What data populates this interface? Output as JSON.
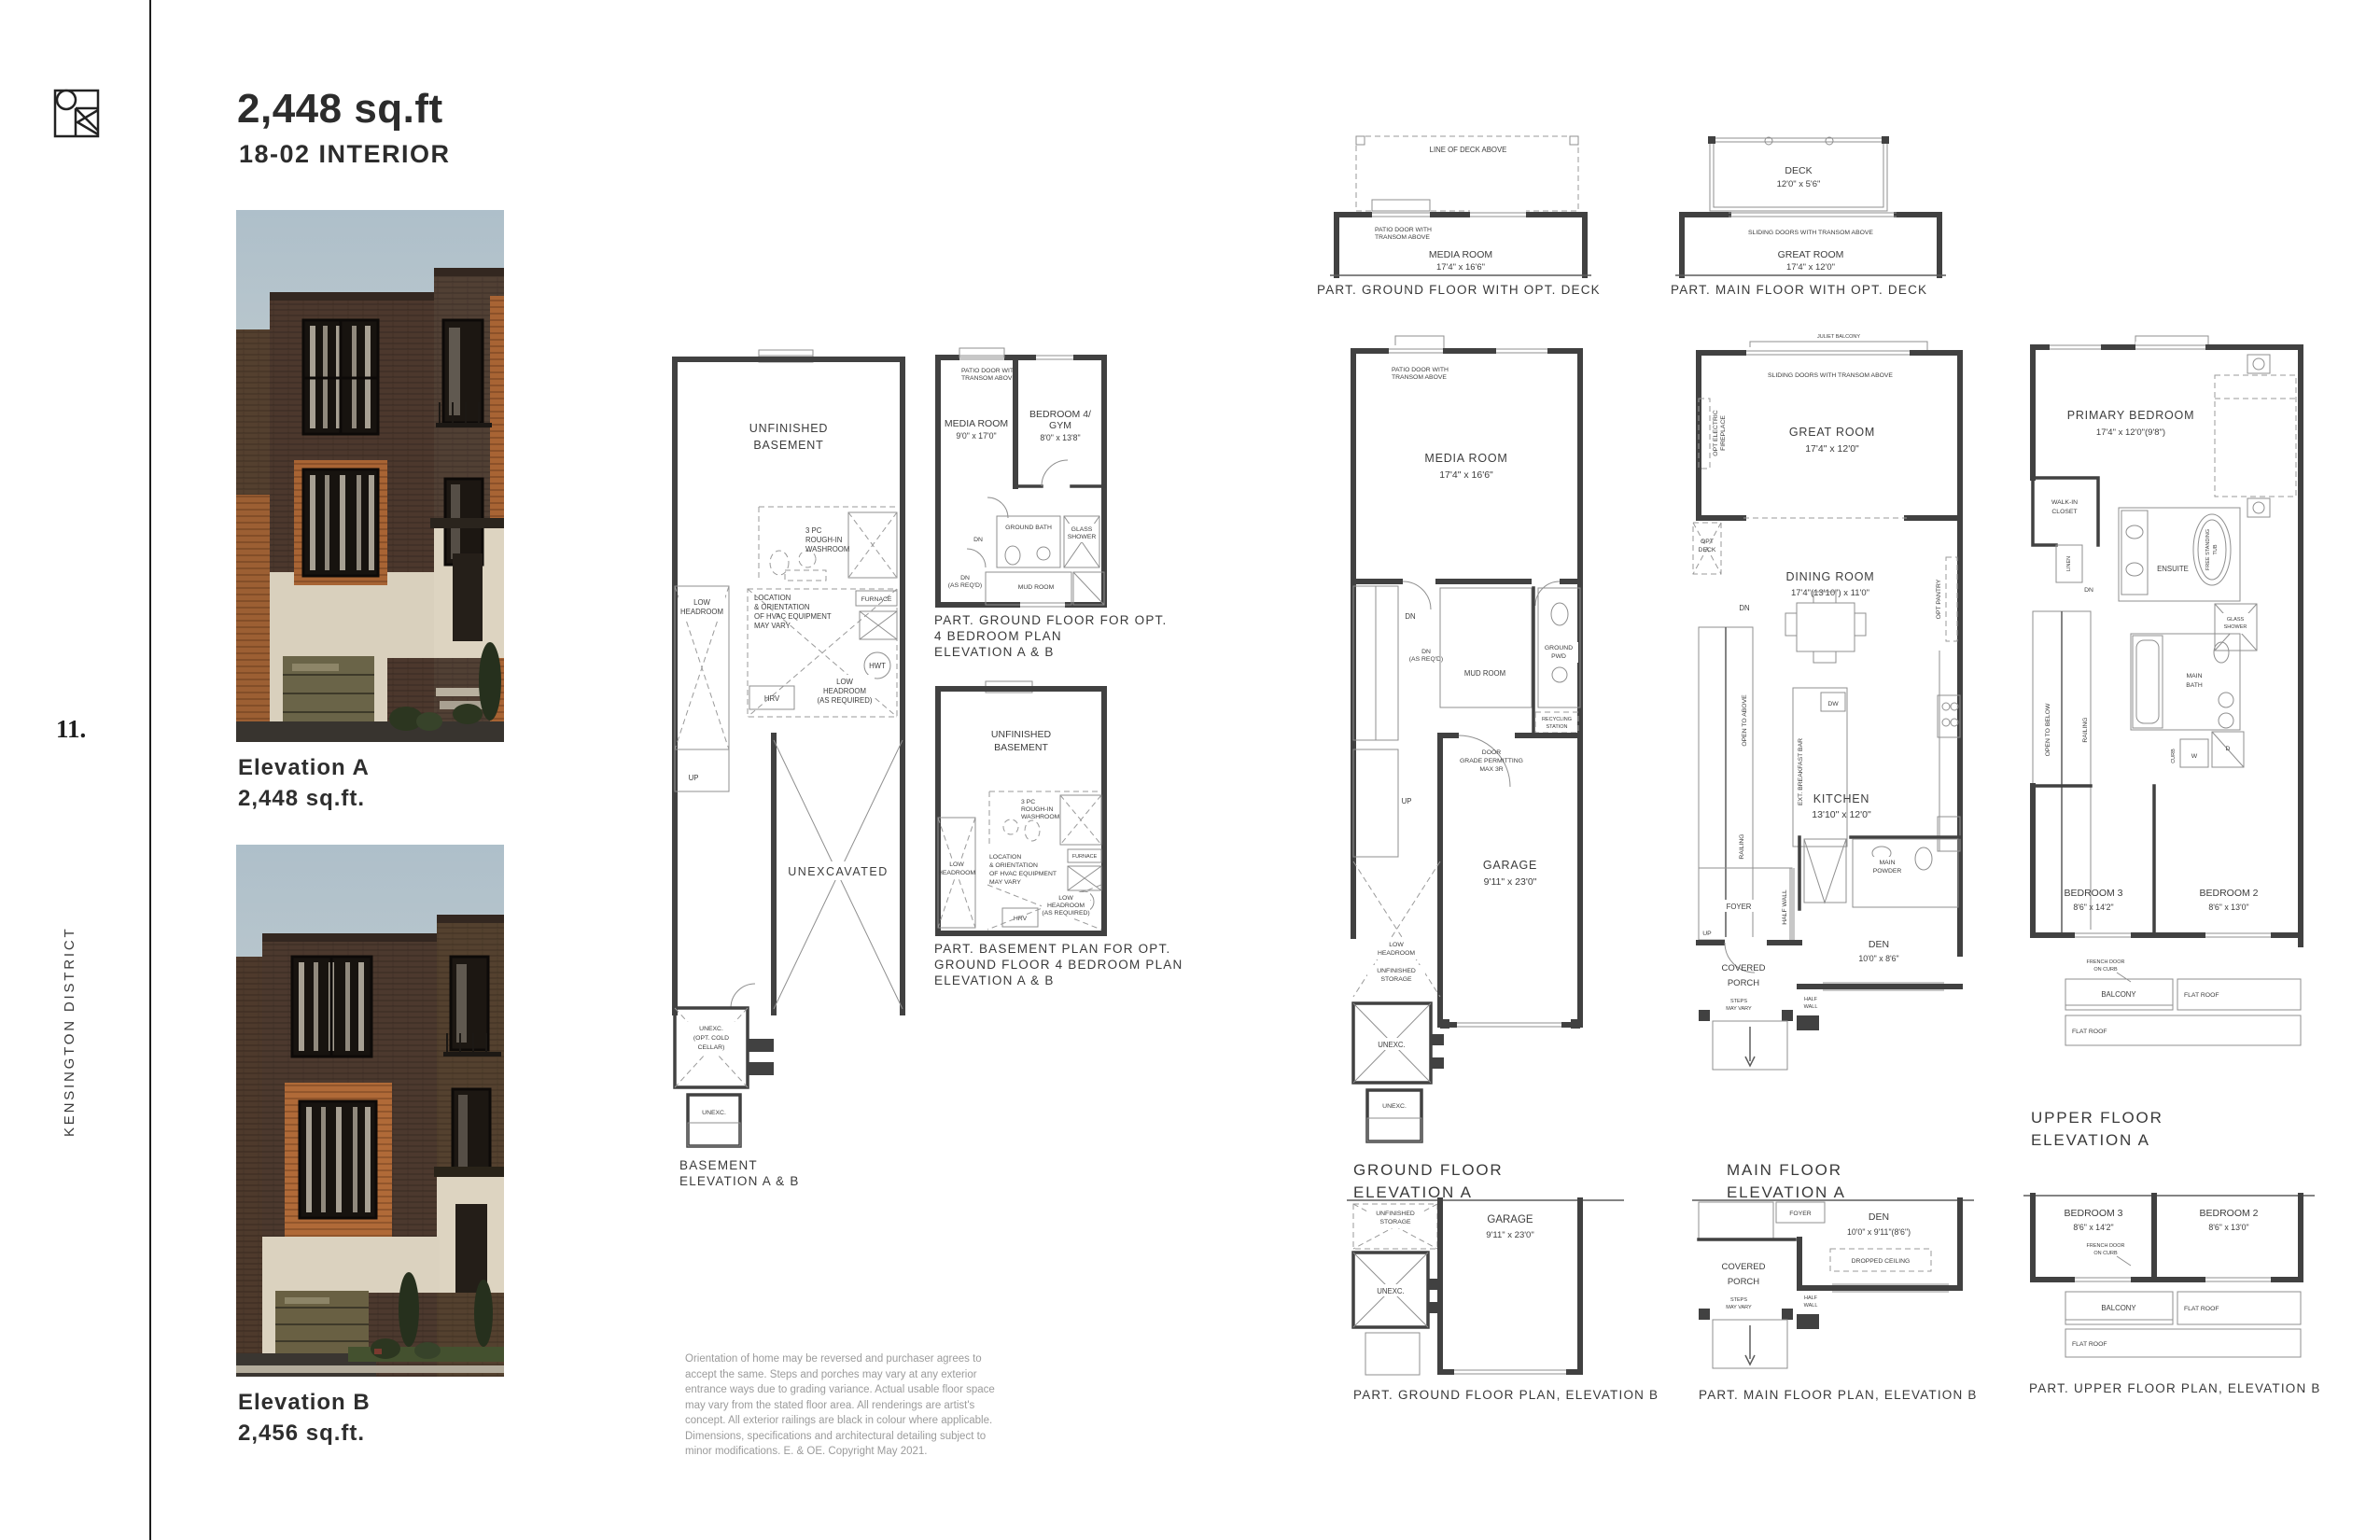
{
  "ink": "#2e2e2e",
  "sidebar": {
    "page_number": "11.",
    "district": "KENSINGTON DISTRICT"
  },
  "header": {
    "title": "2,448 sq.ft",
    "subtitle": "18-02 INTERIOR"
  },
  "elevations": {
    "a": {
      "name": "Elevation A",
      "area": "2,448 sq.ft."
    },
    "b": {
      "name": "Elevation B",
      "area": "2,456 sq.ft."
    }
  },
  "plans": {
    "ground_deck": {
      "caption": "PART. GROUND FLOOR WITH OPT. DECK",
      "line_of_deck": "LINE OF DECK ABOVE",
      "patio_door": [
        "PATIO DOOR WITH",
        "TRANSOM ABOVE"
      ],
      "room": "MEDIA ROOM",
      "room_dim": "17'4\" x 16'6\""
    },
    "main_deck": {
      "caption": "PART. MAIN FLOOR WITH OPT. DECK",
      "deck": "DECK",
      "deck_dim": "12'0\" x 5'6\"",
      "sliding_doors": "SLIDING DOORS WITH TRANSOM ABOVE",
      "room": "GREAT ROOM",
      "room_dim": "17'4\" x 12'0\""
    },
    "ground_4bed": {
      "caption": [
        "PART. GROUND FLOOR FOR OPT.",
        "4 BEDROOM PLAN",
        "ELEVATION A & B"
      ],
      "patio_door": [
        "PATIO DOOR WITH",
        "TRANSOM ABOVE"
      ],
      "media": "MEDIA ROOM",
      "media_dim": "9'0\" x 17'0\"",
      "bed4": [
        "BEDROOM 4/",
        "GYM"
      ],
      "bed4_dim": "8'0\" x 13'8\"",
      "bath": "GROUND BATH",
      "shower": [
        "GLASS",
        "SHOWER"
      ],
      "dn": "DN",
      "dn_req": [
        "DN",
        "(AS REQ'D)"
      ],
      "mud": "MUD ROOM"
    },
    "basement_4bed": {
      "caption": [
        "PART. BASEMENT PLAN FOR OPT.",
        "GROUND FLOOR 4 BEDROOM PLAN",
        "ELEVATION A & B"
      ],
      "unfinished": [
        "UNFINISHED",
        "BASEMENT"
      ],
      "washroom": [
        "3 PC",
        "ROUGH-IN",
        "WASHROOM"
      ],
      "low_head": [
        "LOW",
        "HEADROOM"
      ],
      "hvac": [
        "LOCATION",
        "& ORIENTATION",
        "OF HVAC EQUIPMENT",
        "MAY VARY"
      ],
      "furnace": "FURNACE",
      "hwt": "HWT",
      "hrv": "HRV",
      "low_head_req": [
        "LOW",
        "HEADROOM",
        "(AS REQUIRED)"
      ]
    },
    "basement": {
      "caption": [
        "BASEMENT",
        "ELEVATION A & B"
      ],
      "unfinished": [
        "UNFINISHED",
        "BASEMENT"
      ],
      "washroom": [
        "3 PC",
        "ROUGH-IN",
        "WASHROOM"
      ],
      "low_head": [
        "LOW",
        "HEADROOM"
      ],
      "hvac": [
        "LOCATION",
        "& ORIENTATION",
        "OF HVAC EQUIPMENT",
        "MAY VARY"
      ],
      "furnace": "FURNACE",
      "hwt": "HWT",
      "hrv": "HRV",
      "low_head_req": [
        "LOW",
        "HEADROOM",
        "(AS REQUIRED)"
      ],
      "up": "UP",
      "unexcavated": "UNEXCAVATED",
      "cold_cellar": [
        "UNEXC.",
        "(OPT. COLD",
        "CELLAR)"
      ],
      "unexc": "UNEXC."
    },
    "ground_a": {
      "caption": [
        "GROUND FLOOR",
        "ELEVATION A"
      ],
      "patio_door": [
        "PATIO DOOR WITH",
        "TRANSOM ABOVE"
      ],
      "media": "MEDIA ROOM",
      "media_dim": "17'4\" x 16'6\"",
      "dn": "DN",
      "dn_req": [
        "DN",
        "(AS REQ'D)"
      ],
      "mud": "MUD ROOM",
      "pwd": [
        "GROUND",
        "PWD"
      ],
      "recycling": [
        "RECYCLING",
        "STATION"
      ],
      "door_grade": [
        "DOOR",
        "GRADE PERMITTING",
        "MAX 3R"
      ],
      "up": "UP",
      "garage": "GARAGE",
      "garage_dim": "9'11\" x 23'0\"",
      "low_head": [
        "LOW",
        "HEADROOM"
      ],
      "storage": [
        "UNFINISHED",
        "STORAGE"
      ],
      "unexc": "UNEXC."
    },
    "main_a": {
      "caption": [
        "MAIN FLOOR",
        "ELEVATION A"
      ],
      "juliet": "JULIET BALCONY",
      "sliding": "SLIDING DOORS WITH TRANSOM ABOVE",
      "fireplace": [
        "OPT ELECTRIC",
        "FIREPLACE"
      ],
      "great": "GREAT ROOM",
      "great_dim": "17'4\" x 12'0\"",
      "opt_deck": [
        "OPT",
        "DECK"
      ],
      "dn": "DN",
      "dining": "DINING ROOM",
      "dining_dim": "17'4\"(13'10\") x 11'0\"",
      "pantry": "OPT PANTRY",
      "open_above": "OPEN TO ABOVE",
      "breakfast": "EXT. BREAKFAST BAR",
      "dw": "DW",
      "kitchen": "KITCHEN",
      "kitchen_dim": "13'10\" x 12'0\"",
      "up": "UP",
      "railing": "RAILING",
      "powder": [
        "MAIN",
        "POWDER"
      ],
      "foyer": "FOYER",
      "half_wall_v": "HALF WALL",
      "den": "DEN",
      "den_dim": "10'0\" x 8'6\"",
      "porch": [
        "COVERED",
        "PORCH"
      ],
      "steps": [
        "STEPS",
        "MAY VARY"
      ],
      "half_wall": [
        "HALF",
        "WALL"
      ]
    },
    "upper_a": {
      "caption": [
        "UPPER FLOOR",
        "ELEVATION A"
      ],
      "primary": "PRIMARY BEDROOM",
      "primary_dim": "17'4\" x 12'0\"(9'8\")",
      "wic": [
        "WALK-IN",
        "CLOSET"
      ],
      "linen": "LINEN",
      "dn": "DN",
      "ensuite": "ENSUITE",
      "tub": [
        "FREE STANDING",
        "TUB"
      ],
      "shower": [
        "GLASS",
        "SHOWER"
      ],
      "open_below": "OPEN TO BELOW",
      "railing": "RAILING",
      "bath": [
        "MAIN",
        "BATH"
      ],
      "w": "W",
      "d": "D",
      "curb": "CURB",
      "bed3": "BEDROOM 3",
      "bed3_dim": "8'6\" x 14'2\"",
      "bed2": "BEDROOM 2",
      "bed2_dim": "8'6\" x 13'0\"",
      "french": [
        "FRENCH DOOR",
        "ON CURB"
      ],
      "balcony": "BALCONY",
      "flat_roof": "FLAT ROOF"
    },
    "ground_b": {
      "caption": "PART. GROUND FLOOR PLAN, ELEVATION B",
      "storage": [
        "UNFINISHED",
        "STORAGE"
      ],
      "garage": "GARAGE",
      "garage_dim": "9'11\" x 23'0\"",
      "unexc": "UNEXC."
    },
    "main_b": {
      "caption": "PART. MAIN FLOOR PLAN, ELEVATION B",
      "foyer": "FOYER",
      "den": "DEN",
      "den_dim": "10'0\" x 9'11\"(8'6\")",
      "dropped": "DROPPED CEILING",
      "porch": [
        "COVERED",
        "PORCH"
      ],
      "steps": [
        "STEPS",
        "MAY VARY"
      ],
      "half_wall": [
        "HALF",
        "WALL"
      ]
    },
    "upper_b": {
      "caption": "PART. UPPER FLOOR PLAN, ELEVATION B",
      "bed3": "BEDROOM 3",
      "bed3_dim": "8'6\" x 14'2\"",
      "bed2": "BEDROOM 2",
      "bed2_dim": "8'6\" x 13'0\"",
      "french": [
        "FRENCH DOOR",
        "ON CURB"
      ],
      "balcony": "BALCONY",
      "flat_roof": "FLAT ROOF"
    }
  },
  "disclaimer": {
    "lines": [
      "Orientation of home may be reversed and purchaser agrees to",
      "accept the same. Steps and porches may vary at any exterior",
      "entrance ways due to grading variance. Actual usable floor space",
      "may vary from the stated floor area. All renderings are artist's",
      "concept. All exterior railings are black in colour where applicable.",
      "Dimensions, specifications and architectural detailing subject to",
      "minor modifications. E. & OE. Copyright May 2021."
    ]
  }
}
